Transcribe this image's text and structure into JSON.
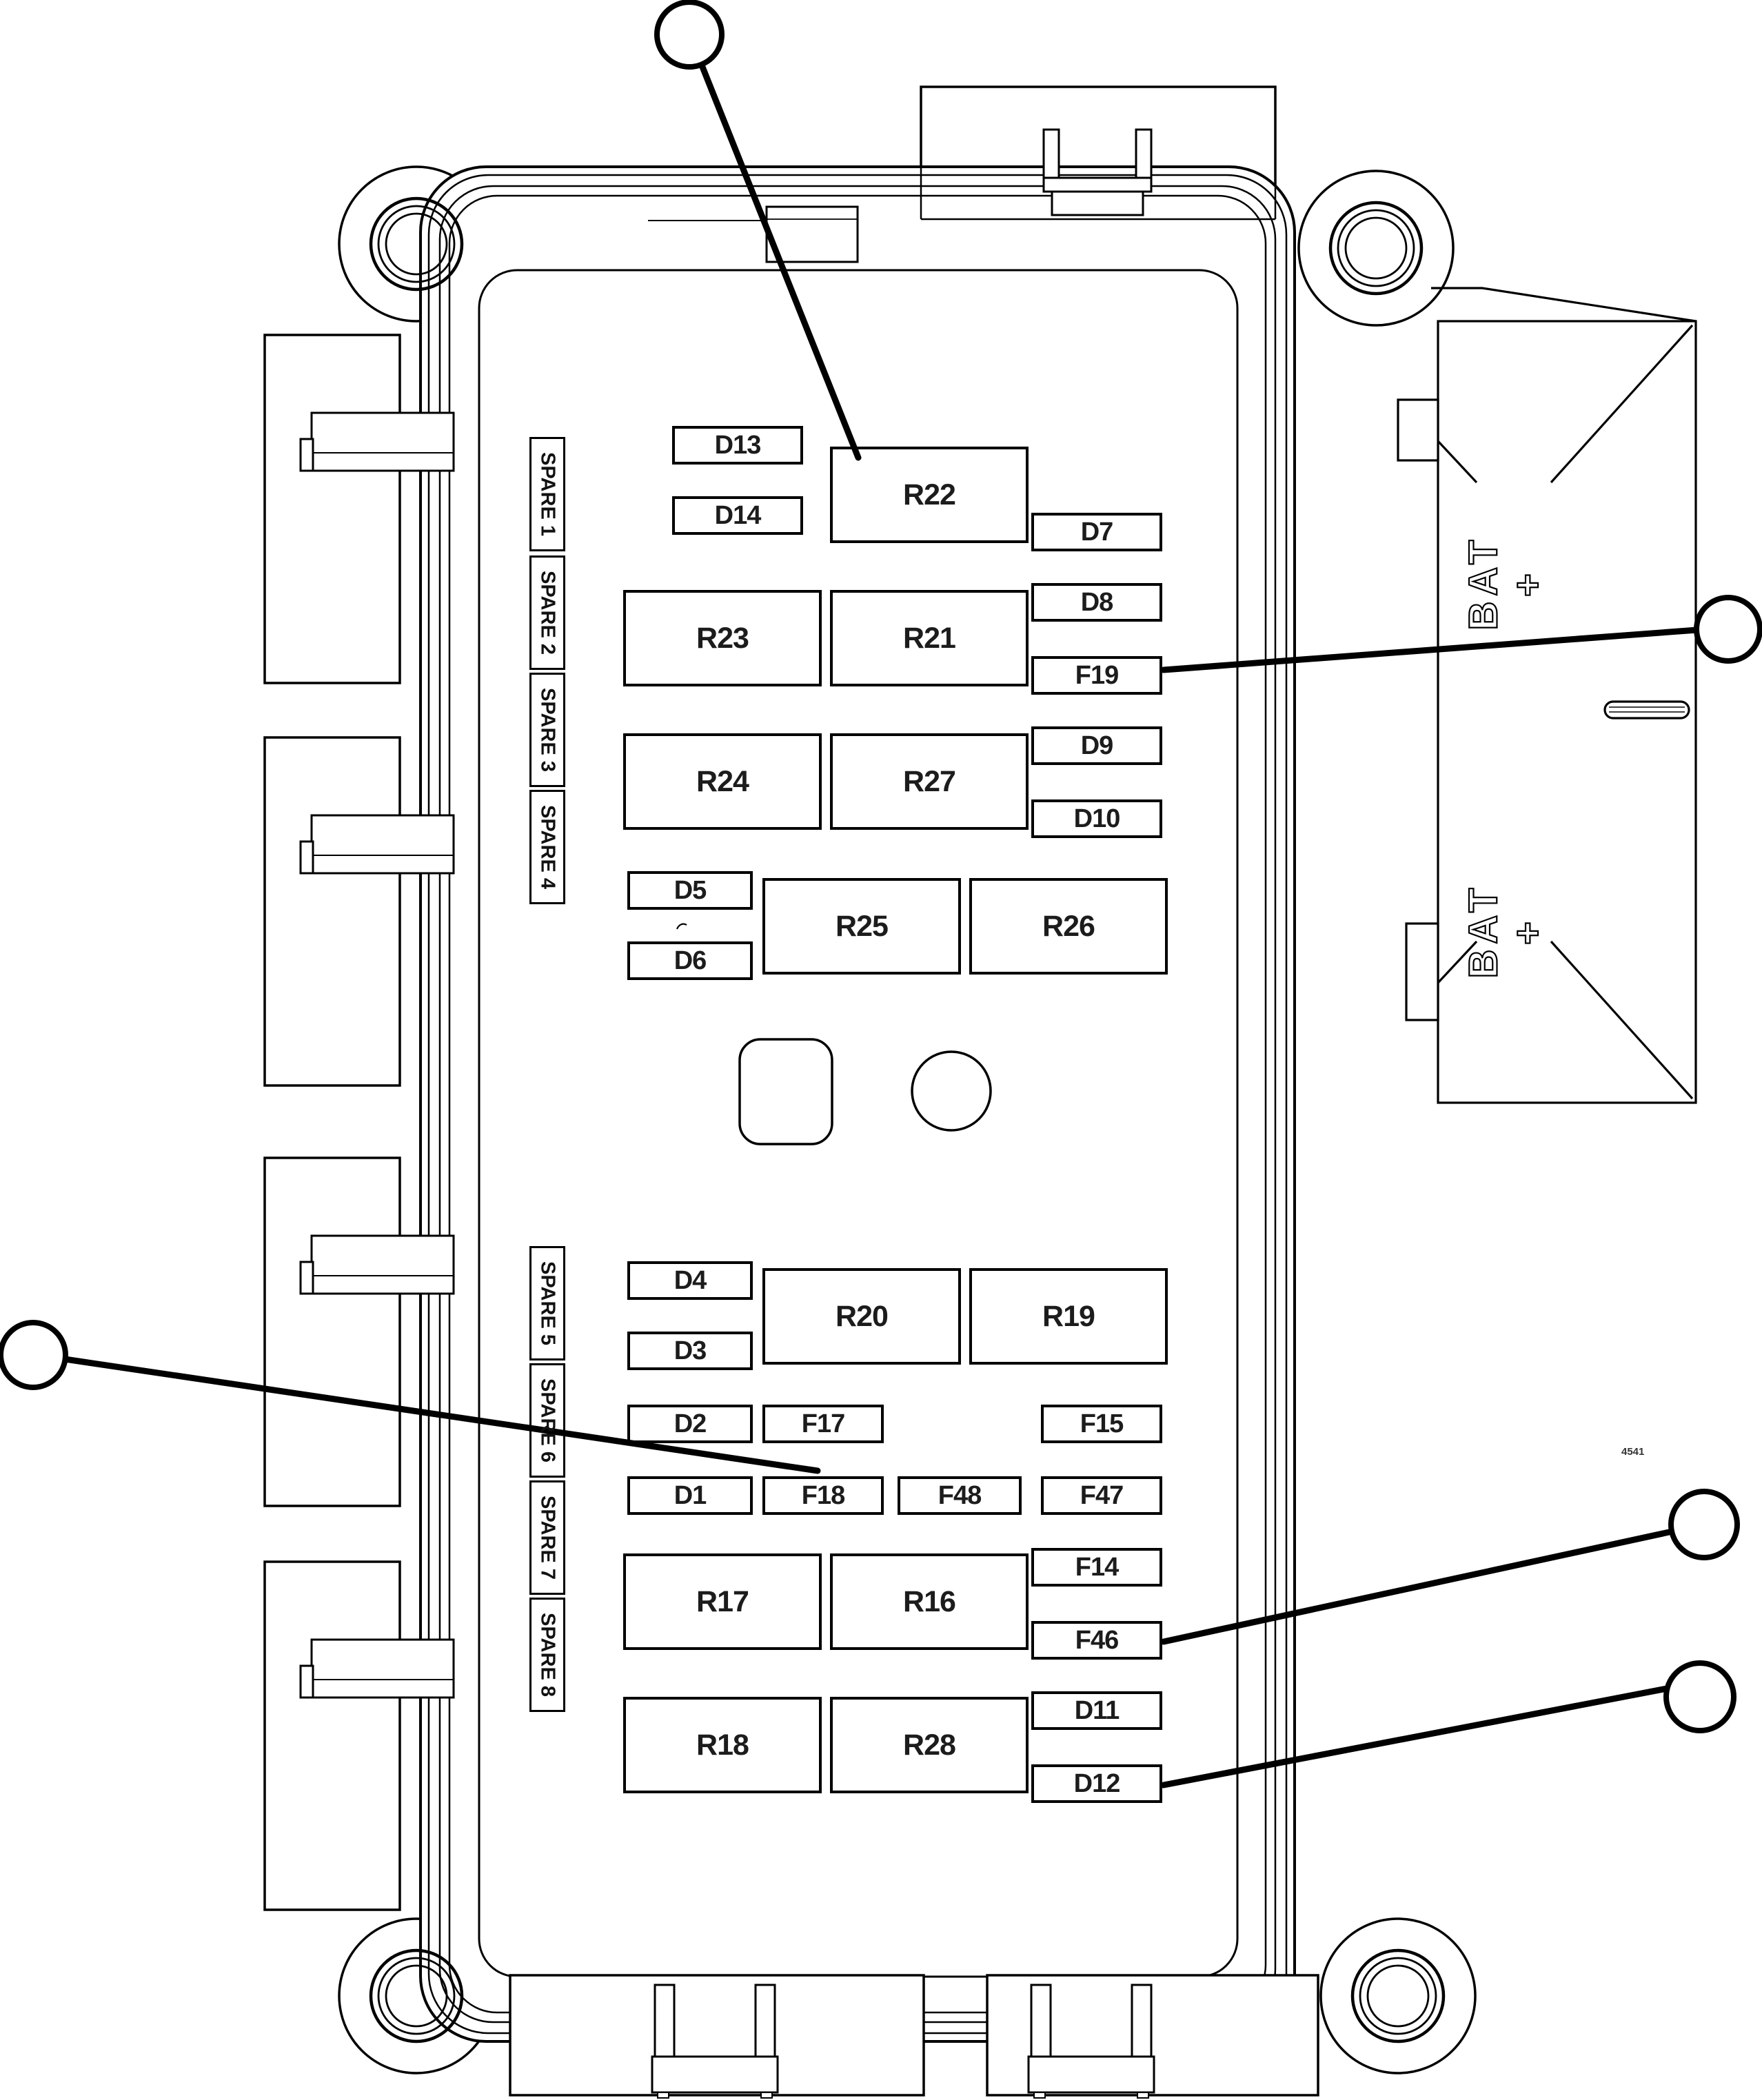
{
  "figure": {
    "kind": "fuse-relay-block-line-drawing",
    "ink_color": "#000000",
    "background_color": "#ffffff",
    "part_number": "4541"
  },
  "spares": {
    "s1": "SPARE 1",
    "s2": "SPARE 2",
    "s3": "SPARE 3",
    "s4": "SPARE 4",
    "s5": "SPARE 5",
    "s6": "SPARE 6",
    "s7": "SPARE 7",
    "s8": "SPARE 8"
  },
  "slots": {
    "d13": "D13",
    "r22": "R22",
    "d14": "D14",
    "d7": "D7",
    "r23": "R23",
    "r21": "R21",
    "d8": "D8",
    "f19": "F19",
    "r24": "R24",
    "r27": "R27",
    "d9": "D9",
    "d10": "D10",
    "d5": "D5",
    "d6": "D6",
    "r25": "R25",
    "r26": "R26",
    "d4": "D4",
    "r20": "R20",
    "r19": "R19",
    "d3": "D3",
    "d2": "D2",
    "f17": "F17",
    "f15": "F15",
    "d1": "D1",
    "f18": "F18",
    "f48": "F48",
    "f47": "F47",
    "f14": "F14",
    "r17": "R17",
    "r16": "R16",
    "f46": "F46",
    "r18": "R18",
    "r28": "R28",
    "d11": "D11",
    "d12": "D12"
  },
  "battery": {
    "line1": "BAT",
    "line2": "+"
  }
}
